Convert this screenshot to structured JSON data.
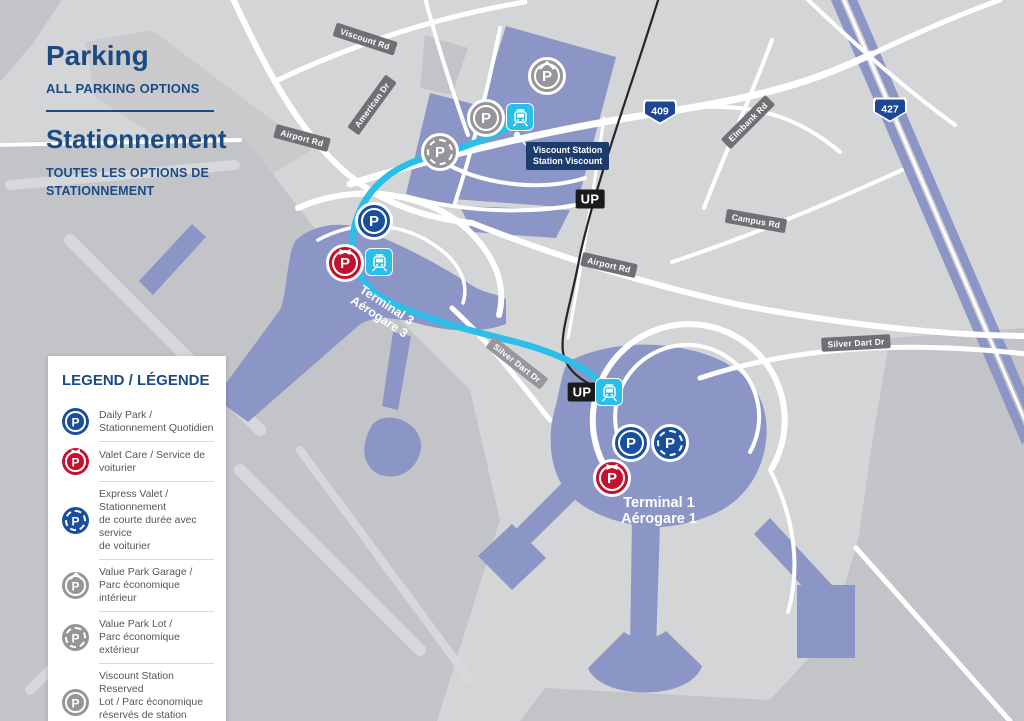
{
  "header": {
    "title_en": "Parking",
    "subtitle_en": "ALL PARKING OPTIONS",
    "title_fr": "Stationnement",
    "subtitle_fr": "TOUTES LES OPTIONS DE\nSTATIONNEMENT"
  },
  "legend": {
    "title": "LEGEND / LÉGENDE",
    "items": [
      {
        "icon": "daily-park-icon",
        "label": "Daily Park /\nStationnement Quotidien"
      },
      {
        "icon": "valet-care-icon",
        "label": "Valet Care / Service de voiturier"
      },
      {
        "icon": "express-valet-icon",
        "label": "Express Valet / Stationnement\nde courte durée avec service\nde voiturier"
      },
      {
        "icon": "value-park-garage-icon",
        "label": "Value Park Garage /\nParc économique intérieur"
      },
      {
        "icon": "value-park-lot-icon",
        "label": "Value Park Lot /\nParc économique extérieur"
      },
      {
        "icon": "viscount-station-reserved-icon",
        "label": "Viscount Station Reserved\nLot / Parc économique\nréservés de station Viscount"
      }
    ]
  },
  "map": {
    "road_labels": [
      {
        "id": "viscount-rd",
        "text": "Viscount Rd"
      },
      {
        "id": "american-dr",
        "text": "American Dr"
      },
      {
        "id": "airport-rd-west",
        "text": "Airport Rd"
      },
      {
        "id": "airport-rd-east",
        "text": "Airport Rd"
      },
      {
        "id": "elmbank-rd",
        "text": "Elmbank Rd"
      },
      {
        "id": "campus-rd",
        "text": "Campus Rd"
      },
      {
        "id": "silver-dart-west",
        "text": "Silver Dart Dr"
      },
      {
        "id": "silver-dart-east",
        "text": "Silver Dart Dr"
      }
    ],
    "shields": [
      {
        "text": "409"
      },
      {
        "text": "427"
      }
    ],
    "up_badges": [
      "UP",
      "UP"
    ],
    "station_badge": {
      "line1": "Viscount Station",
      "line2": "Station Viscount"
    },
    "terminal3": {
      "line1": "Terminal 3",
      "line2": "Aérogare 3"
    },
    "terminal1": {
      "line1": "Terminal 1",
      "line2": "Aérogare 1"
    }
  },
  "icons": {
    "p": "P"
  },
  "colors": {
    "background_gray": "#d4d5d7",
    "airfield_dark_gray": "#c3c4c8",
    "building_periwinkle": "#8c96c6",
    "route_cyan": "#2abfe8",
    "navy_text": "#1b4b85",
    "daily_park_blue": "#1a4f9c",
    "valet_red": "#c2122f",
    "value_gray": "#96969a",
    "up_badge_black": "#1b1b1e",
    "shield_blue": "#1d4796",
    "station_badge_navy": "#1d3c6e",
    "road_label_gray": "#707074"
  }
}
